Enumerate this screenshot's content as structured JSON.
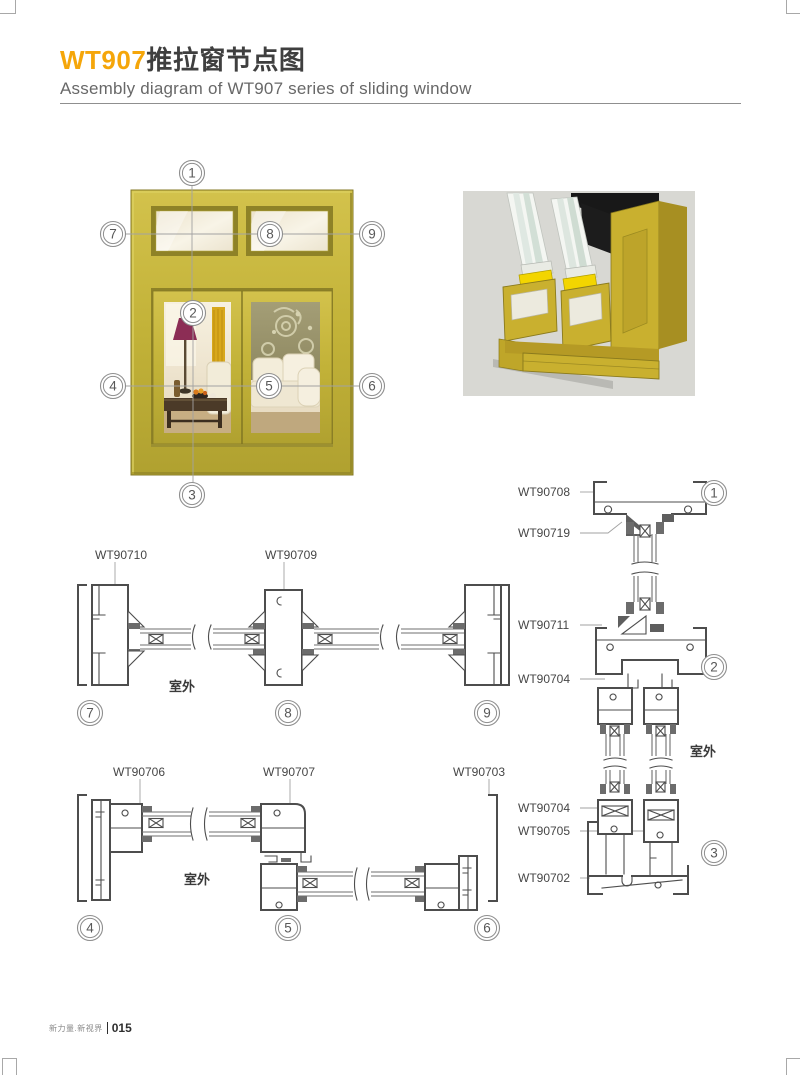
{
  "page": {
    "title_code": "WT907",
    "title_cn": "推拉窗节点图",
    "subtitle": "Assembly diagram of WT907 series of sliding window",
    "footer": {
      "brand": "新力量.新视界",
      "page_no": "015"
    }
  },
  "colors": {
    "accent": "#F5A60A",
    "frame_gold": "#C6B63B",
    "drawing_line": "#4D4D4D",
    "render_background": "#D8D8D3"
  },
  "overview": {
    "callouts": [
      "1",
      "2",
      "3",
      "4",
      "5",
      "6",
      "7",
      "8",
      "9"
    ]
  },
  "sections": {
    "middle": {
      "labels": [
        "WT90710",
        "WT90709"
      ],
      "outdoor": "室外",
      "callouts": [
        "7",
        "8",
        "9"
      ]
    },
    "bottom": {
      "labels": [
        "WT90706",
        "WT90707",
        "WT90703"
      ],
      "outdoor": "室外",
      "callouts": [
        "4",
        "5",
        "6"
      ]
    },
    "right": {
      "labels": [
        "WT90708",
        "WT90719",
        "WT90711",
        "WT90704",
        "WT90704",
        "WT90705",
        "WT90702"
      ],
      "outdoor": "室外",
      "callouts": [
        "1",
        "2",
        "3"
      ]
    }
  }
}
